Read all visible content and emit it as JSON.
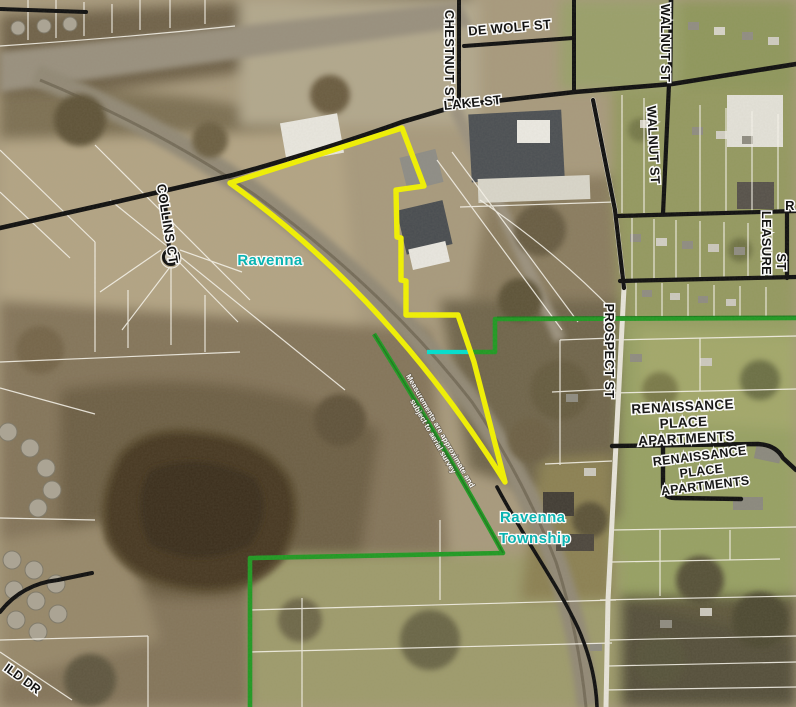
{
  "map": {
    "streets": {
      "de_wolf": "DE WOLF ST",
      "chestnut": "CHESTNUT ST",
      "lake": "LAKE ST",
      "walnut_north": "WALNUT ST",
      "walnut_south": "WALNUT ST",
      "leasure_word1": "LEASURE",
      "leasure_word2": "ST",
      "prospect": "PROSPECT ST",
      "collins": "COLLINS CT",
      "partial_right_edge": "R",
      "partial_bottom_left": "ILD DR"
    },
    "places": {
      "municipality": "Ravenna",
      "township": {
        "lines": [
          "Ravenna",
          "Township"
        ]
      },
      "renaissance_north": {
        "lines": [
          "RENAISSANCE",
          "PLACE",
          "APARTMENTS"
        ]
      },
      "renaissance_south": {
        "lines": [
          "RENAISSANCE",
          "PLACE",
          "APARTMENTS"
        ]
      }
    },
    "disclaimer": {
      "lines": [
        "Measurements are approximate and",
        "subject to aerial survey"
      ]
    },
    "colors": {
      "highlight_parcel": "#f2f200",
      "boundary_green": "#1f9a22",
      "boundary_cyan": "#00e0cf",
      "municipality_cyan": "#00b4b4",
      "road_black": "#0e0e0e",
      "parcel_white": "#f8f5ec"
    }
  }
}
